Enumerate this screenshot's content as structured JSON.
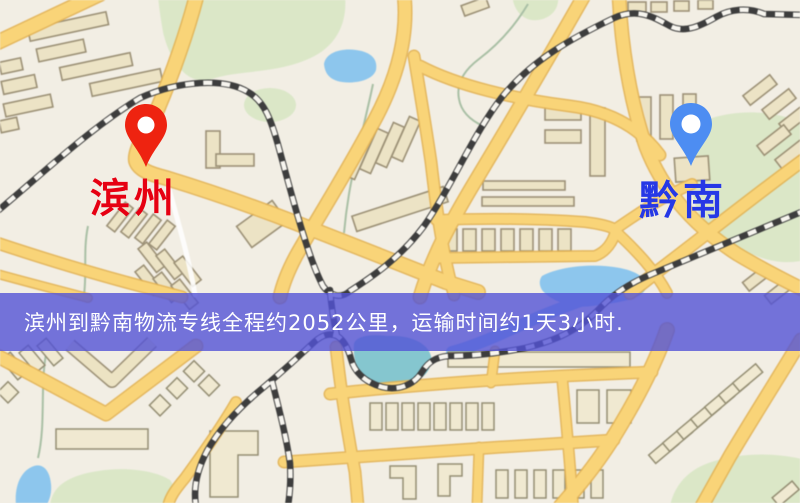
{
  "type": "logistics-route-map-screenshot",
  "map": {
    "description": "Chinese city road map with buildings, parks, ponds and railways",
    "colors": {
      "background": "#f2eee4",
      "road": "#f8d47a",
      "road_casing": "#e2b254",
      "building_fill": "#ece3c6",
      "building_stroke": "#9c9177",
      "park": "#dbe7c8",
      "water": "#8ec6ec",
      "railway": "#3d3d3d"
    }
  },
  "markers": {
    "origin": {
      "label": "滨州",
      "pin_color": "#ee2310",
      "label_color": "#e60012"
    },
    "destination": {
      "label": "黔南",
      "pin_color": "#4d8df2",
      "label_color": "#2638e6"
    }
  },
  "banner": {
    "text": "滨州到黔南物流专线全程约2052公里，运输时间约1天3小时.",
    "background_color": "#5252d6",
    "opacity": 0.8,
    "text_color": "#ffffff"
  }
}
